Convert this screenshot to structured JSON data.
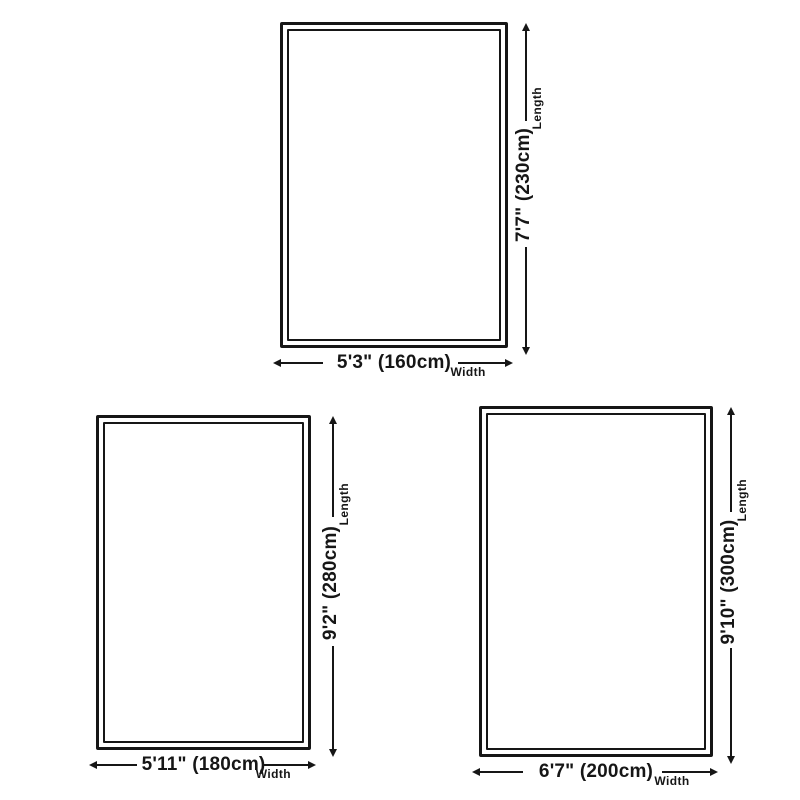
{
  "colors": {
    "background": "#ffffff",
    "line": "#161616"
  },
  "diagrams": [
    {
      "length_label": "Length",
      "length_value": "7'7\" (230cm)",
      "width_label": "Width",
      "width_value": "5'3\" (160cm)"
    },
    {
      "length_label": "Length",
      "length_value": "9'2\" (280cm)",
      "width_label": "Width",
      "width_value": "5'11\" (180cm)"
    },
    {
      "length_label": "Length",
      "length_value": "9'10\" (300cm)",
      "width_label": "Width",
      "width_value": "6'7\" (200cm)"
    }
  ]
}
